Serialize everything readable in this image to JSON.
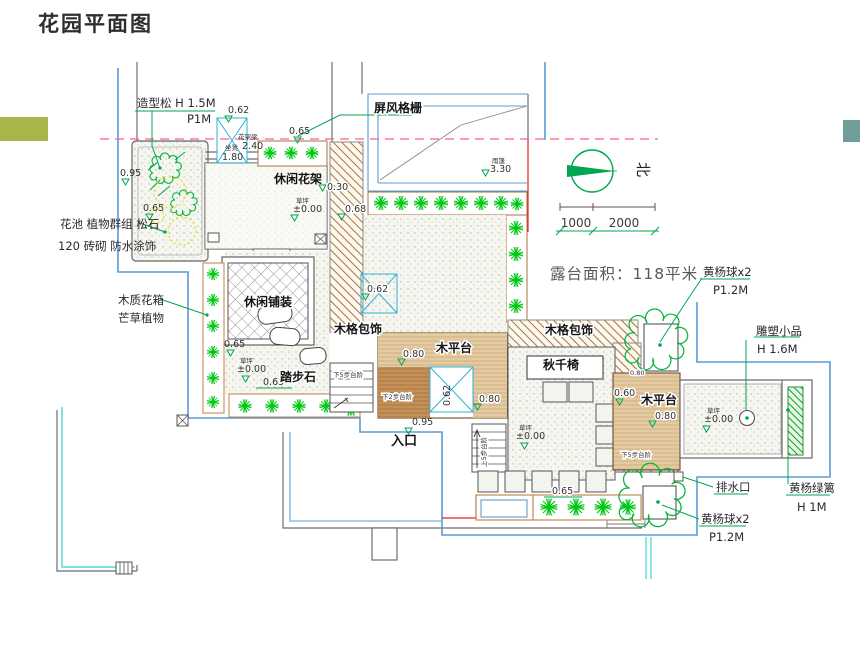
{
  "colors": {
    "accent_left": "#a9b44b",
    "accent_right": "#6f9e9a",
    "boundary_blue": "#5b9bd5",
    "cad_green": "#00a651",
    "plant_green": "#00c814",
    "red_line": "#e02020",
    "pink_dash": "#ff5f8a",
    "hatch_brown": "#a8733c",
    "wall_gray": "#6e6e6e"
  },
  "ann": {
    "title": "花园平面图",
    "zaoxingsong": "造型松 H 1.5M",
    "p1m": "P1M",
    "pingfeng": "屏风格栅",
    "yupeng": "雨篷",
    "e330": "3.30",
    "e062": "0.62",
    "huajialiang": "花架梁",
    "e240": "2.40",
    "zuodeng": "坐凳",
    "e180": "1.80",
    "e065": "0.65",
    "e095": "0.95",
    "e030": "0.30",
    "e068": "0.68",
    "e060": "0.60",
    "e080": "0.80",
    "e000": "±0.00",
    "caoping": "草坪",
    "xiuxianhuajia": "休闲花架",
    "huachi": "花池 植物群组 松石",
    "zhuanqi": "120 砖砌 防水涂饰",
    "muzhihuaxiang": "木质花箱",
    "mangcao": "芒草植物",
    "xiuxianpuzhuang": "休闲铺装",
    "tabushi": "踏步石",
    "mugebaoshi": "木格包饰",
    "mupingtai": "木平台",
    "qiuqianyi": "秋千椅",
    "xia2bu": "下2步台阶",
    "xia5bu": "下5步台阶",
    "shang5bu": "上5步台阶",
    "rukou": "入口",
    "north": "北",
    "s1000": "1000",
    "s2000": "2000",
    "lutai": "露台面积：118平米",
    "huangyangqiu": "黄杨球x2",
    "p12m": "P1.2M",
    "diaosu": "雕塑小品",
    "h16m": "H 1.6M",
    "paishuikou": "排水口",
    "huangyanglvli": "黄杨绿篱",
    "h1m": "H 1M"
  }
}
